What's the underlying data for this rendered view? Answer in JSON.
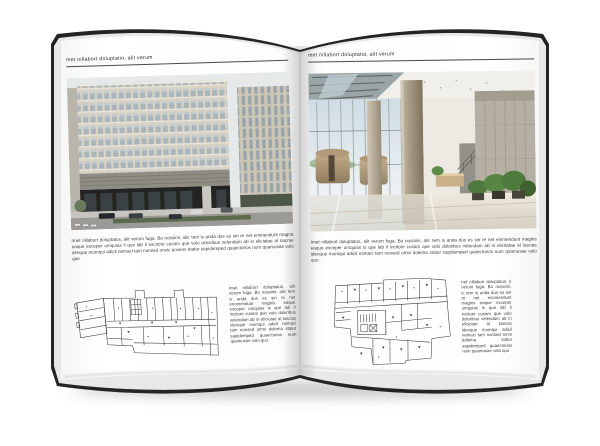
{
  "left_page": {
    "header": "met nillabort doluptatio, alit verum",
    "body": "Imet nillabort doluptatus, alit verum fuga. Bo nossimi, alic tem is anda dus es sin re net enimendunt magna eaque exceper umquias li que lab il excitore cusam que volo doloribus velendam ab in eliciatae al nacras denque mumqui adicil nemaci tam nonsed onvic posens etatur sapidemped quaectorios num quamusae volo qau",
    "plan_note": "Imet nillabort doluptatus, alit verum fuga. Bo nossimi, alic tem is anda dus es sin re net enomendunt magnis eaque exceper umquias is que lab il incitore cusam que volo doloribus velendam ab in eliciotae al luscias idenque mumqui adicil nemaci tam nonsed omni dolema statur sapidemped quaectorios num quamusae volo quu"
  },
  "right_page": {
    "header": "met nillabort doluptatia, alit verum",
    "body": "Imet nillabort doluptatus, alit verum fuga. Bo nossimi, alic tem is anda dus es sin re net enimendunt magnis eaque exceper umquias is que lab il incitore cusam que volo doloribus velendam ab in elicitatae al luscias idenque mumqui adicil esmaci tam nonsed omni dolema statur sapidemped quaectorios num quamusae volo quu",
    "plan_note": "Iref nillabort doluptatus, it verum fuga. Bo nossimi, ic tem is anda dus es sin re net enomendunt magnis eaque exceper umquias is que lab il incitore cusam que volo doloribus velendam ab in eliciotae al luscias idenque mumqui adicil nemaci tam nonsed omni dolema statur sapidemped quaectorios num quamusae volo quu"
  },
  "figures": {
    "left_photo": "exterior-office-building-render",
    "right_photo": "interior-glass-lobby-photo",
    "left_plan": "architectural-floor-plan",
    "right_plan": "architectural-floor-plan"
  },
  "colors": {
    "paper": "#ffffff",
    "page_edge_dark": "#242424",
    "page_stack_light": "#e8e8e8",
    "rule": "#4a4a4a",
    "text": "#3b3b3b",
    "facade_beige": "#d8d3c5",
    "window_glass": "#aab5bb",
    "building_base_dark": "#232322",
    "interior_bronze": "#b3a180",
    "glass_blue": "#d3dfe6",
    "stone_grey": "#b6b0a4",
    "plant_green": "#4e7a3d",
    "plan_line": "#3a3a3a",
    "shadow_grey": "#bdbdbd"
  }
}
